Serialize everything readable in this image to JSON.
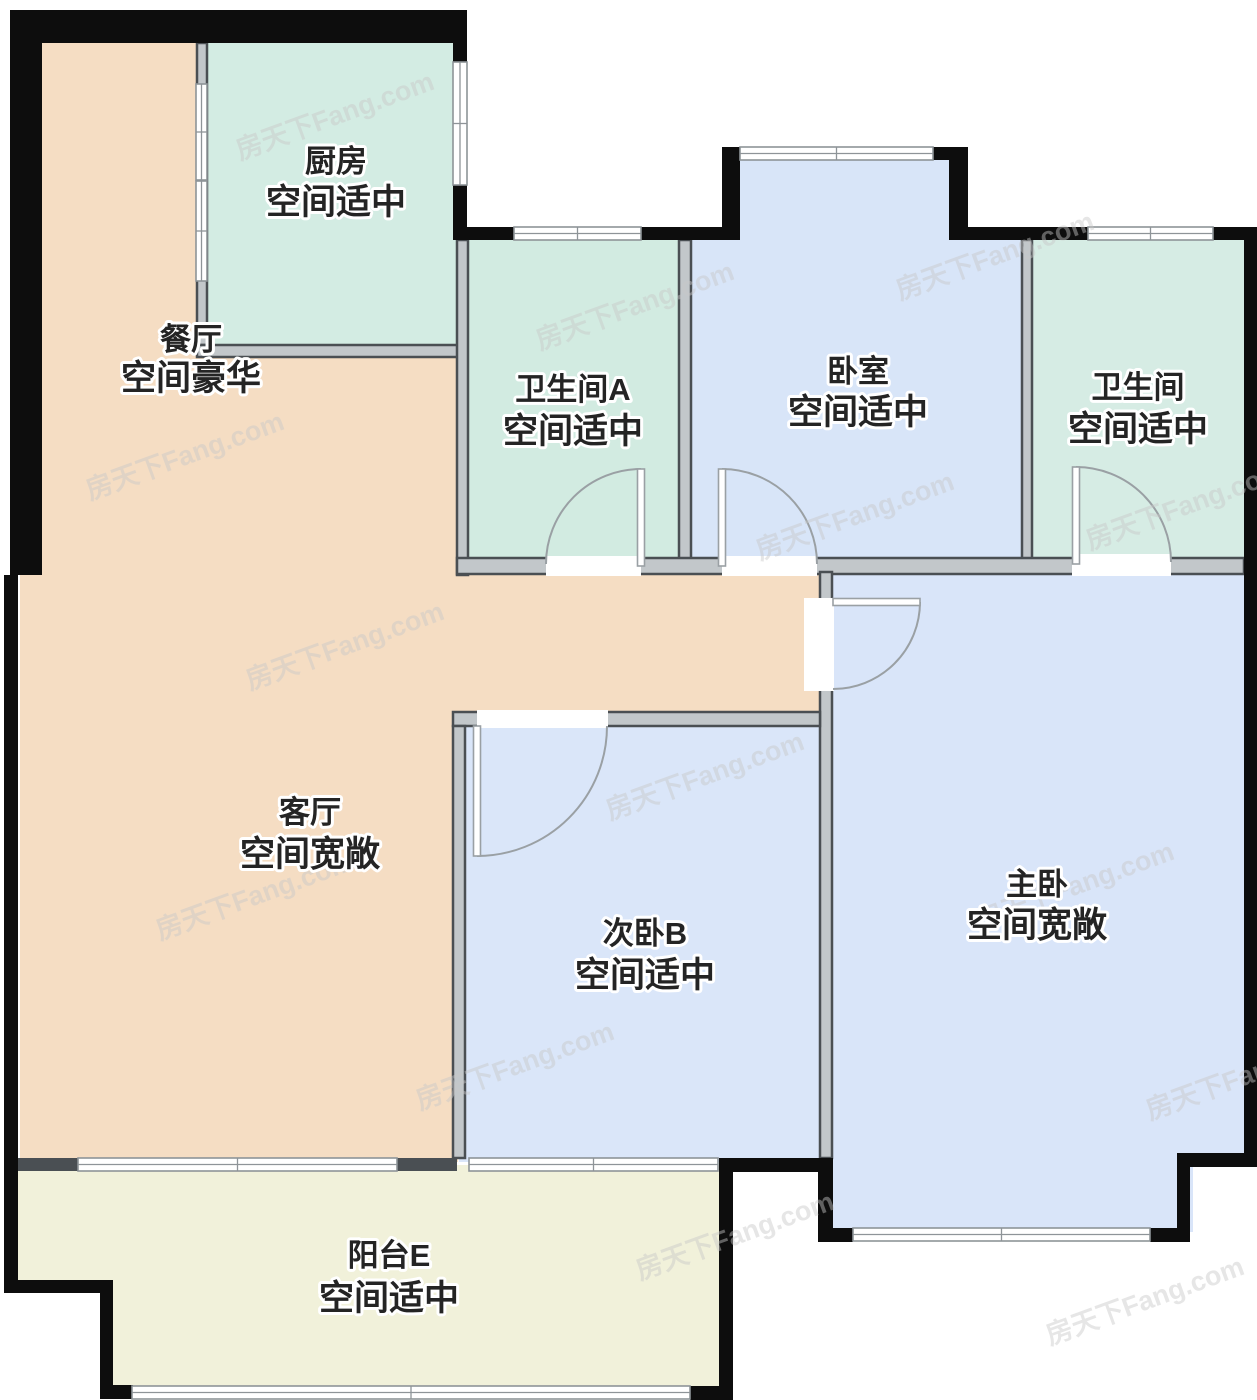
{
  "floorplan": {
    "canvas": {
      "width": 1257,
      "height": 1400,
      "background": "#ffffff"
    },
    "colors": {
      "exterior_wall": "#0d0d0d",
      "interior_wall_fill": "#c2c7ca",
      "interior_wall_edge": "#4a4f53",
      "stub_wall_fill": "#4a4f53",
      "window_stroke": "#8e9498",
      "door_stroke": "#9aa0a4",
      "label_color": "#242424",
      "label_halo": "#ffffff",
      "watermark_color": "#d2d2d2"
    },
    "watermark": {
      "text": "房天下Fang.com",
      "font_size": 27,
      "rotation": -20,
      "opacity": 0.45,
      "positions": [
        [
          240,
          160
        ],
        [
          90,
          500
        ],
        [
          250,
          690
        ],
        [
          540,
          350
        ],
        [
          160,
          940
        ],
        [
          420,
          1110
        ],
        [
          610,
          820
        ],
        [
          760,
          560
        ],
        [
          900,
          300
        ],
        [
          1090,
          550
        ],
        [
          980,
          930
        ],
        [
          1150,
          1120
        ],
        [
          640,
          1280
        ],
        [
          1050,
          1345
        ]
      ]
    },
    "areas": [
      {
        "id": "dining-living",
        "color": "#f5ddc3",
        "rects": [
          [
            20,
            20,
            185,
            340
          ],
          [
            20,
            340,
            440,
            240
          ],
          [
            20,
            566,
            806,
            152
          ],
          [
            20,
            712,
            438,
            450
          ]
        ]
      },
      {
        "id": "kitchen",
        "color": "#d3ece3",
        "rects": [
          [
            203,
            40,
            255,
            310
          ]
        ]
      },
      {
        "id": "bath-a",
        "color": "#d2ebe1",
        "rects": [
          [
            463,
            235,
            221,
            327
          ]
        ]
      },
      {
        "id": "bedroom",
        "color": "#d8e5f8",
        "rects": [
          [
            728,
            152,
            226,
            92
          ],
          [
            686,
            235,
            340,
            327
          ]
        ]
      },
      {
        "id": "bath-right",
        "color": "#d6ece4",
        "rects": [
          [
            1028,
            235,
            220,
            327
          ]
        ]
      },
      {
        "id": "master-bedroom",
        "color": "#d9e5f9",
        "rects": [
          [
            827,
            566,
            420,
            592
          ],
          [
            827,
            1150,
            366,
            82
          ]
        ]
      },
      {
        "id": "bedroom-b",
        "color": "#dae6f9",
        "rects": [
          [
            459,
            718,
            365,
            444
          ]
        ]
      },
      {
        "id": "balcony",
        "color": "#f1f1da",
        "rects": [
          [
            18,
            1165,
            704,
            120
          ],
          [
            108,
            1270,
            614,
            120
          ]
        ]
      }
    ],
    "exterior_walls": [
      [
        10,
        10,
        457,
        33
      ],
      [
        10,
        10,
        32,
        565
      ],
      [
        4,
        575,
        14,
        717
      ],
      [
        453,
        43,
        14,
        19
      ],
      [
        453,
        185,
        14,
        55
      ],
      [
        453,
        227,
        61,
        13
      ],
      [
        641,
        227,
        99,
        13
      ],
      [
        722,
        147,
        18,
        93
      ],
      [
        933,
        147,
        35,
        13
      ],
      [
        949,
        147,
        19,
        93
      ],
      [
        968,
        227,
        120,
        13
      ],
      [
        1213,
        227,
        44,
        13
      ],
      [
        1244,
        227,
        13,
        940
      ],
      [
        1177,
        1153,
        80,
        14
      ],
      [
        1177,
        1153,
        13,
        89
      ],
      [
        1150,
        1228,
        40,
        14
      ],
      [
        818,
        1228,
        35,
        14
      ],
      [
        818,
        1158,
        15,
        84
      ],
      [
        719,
        1158,
        114,
        14
      ],
      [
        719,
        1158,
        14,
        242
      ],
      [
        690,
        1386,
        43,
        14
      ],
      [
        100,
        1385,
        33,
        14
      ],
      [
        100,
        1280,
        13,
        119
      ],
      [
        4,
        1280,
        109,
        13
      ]
    ],
    "interior_walls": [
      [
        197,
        43,
        10,
        302
      ],
      [
        197,
        345,
        270,
        12
      ],
      [
        457,
        240,
        11,
        335
      ],
      [
        679,
        240,
        12,
        332
      ],
      [
        1022,
        240,
        10,
        332
      ],
      [
        457,
        558,
        787,
        16
      ],
      [
        820,
        572,
        12,
        586
      ],
      [
        453,
        712,
        367,
        14
      ],
      [
        453,
        726,
        12,
        432
      ]
    ],
    "stub_walls": [
      [
        18,
        1158,
        60,
        13
      ],
      [
        397,
        1158,
        60,
        13
      ]
    ],
    "door_gaps": [
      [
        546,
        556,
        95,
        20
      ],
      [
        722,
        556,
        95,
        20
      ],
      [
        1072,
        554,
        99,
        22
      ],
      [
        804,
        598,
        30,
        93
      ],
      [
        477,
        710,
        131,
        18
      ]
    ],
    "windows": [
      {
        "x": 453,
        "y": 62,
        "w": 14,
        "h": 123,
        "o": "v"
      },
      {
        "x": 196,
        "y": 84,
        "w": 11,
        "h": 96,
        "o": "v"
      },
      {
        "x": 196,
        "y": 181,
        "w": 11,
        "h": 100,
        "o": "v"
      },
      {
        "x": 514,
        "y": 227,
        "w": 127,
        "h": 13,
        "o": "h"
      },
      {
        "x": 740,
        "y": 147,
        "w": 193,
        "h": 13,
        "o": "h"
      },
      {
        "x": 1088,
        "y": 227,
        "w": 125,
        "h": 13,
        "o": "h"
      },
      {
        "x": 853,
        "y": 1228,
        "w": 297,
        "h": 13,
        "o": "h"
      },
      {
        "x": 469,
        "y": 1158,
        "w": 249,
        "h": 13,
        "o": "h"
      },
      {
        "x": 78,
        "y": 1158,
        "w": 319,
        "h": 13,
        "o": "h"
      },
      {
        "x": 132,
        "y": 1386,
        "w": 558,
        "h": 13,
        "o": "h"
      }
    ],
    "doors": [
      {
        "id": "door-bath-a",
        "arc": "M 546 564 A 95 95 0 0 1 641 469",
        "leaf": [
          637.5,
          469,
          7,
          97
        ]
      },
      {
        "id": "door-bedroom",
        "arc": "M 722 469 A 95 95 0 0 1 817 564",
        "leaf": [
          718.5,
          469,
          7,
          97
        ]
      },
      {
        "id": "door-bath-right",
        "arc": "M 1076 467 A 95 95 0 0 1 1171 562",
        "leaf": [
          1072.5,
          467,
          7,
          97
        ]
      },
      {
        "id": "door-master",
        "arc": "M 920 602 A 87 87 0 0 1 833 689",
        "leaf": [
          833,
          598.5,
          87,
          7
        ]
      },
      {
        "id": "door-bedroom-b",
        "arc": "M 477 856 A 130 130 0 0 0 607 726",
        "leaf": [
          473.5,
          726,
          7,
          130
        ]
      }
    ],
    "labels": [
      {
        "id": "kitchen",
        "line1": "厨房",
        "line2": "空间适中",
        "x": 336,
        "y1": 172,
        "y2": 214
      },
      {
        "id": "dining",
        "line1": "餐厅",
        "line2": "空间豪华",
        "x": 191,
        "y1": 350,
        "y2": 390
      },
      {
        "id": "bath-a",
        "line1": "卫生间A",
        "line2": "空间适中",
        "x": 573,
        "y1": 400,
        "y2": 443
      },
      {
        "id": "bedroom",
        "line1": "卧室",
        "line2": "空间适中",
        "x": 858,
        "y1": 382,
        "y2": 424
      },
      {
        "id": "bath-right",
        "line1": "卫生间",
        "line2": "空间适中",
        "x": 1138,
        "y1": 398,
        "y2": 441
      },
      {
        "id": "living",
        "line1": "客厅",
        "line2": "空间宽敞",
        "x": 310,
        "y1": 823,
        "y2": 866
      },
      {
        "id": "bedroom-b",
        "line1": "次卧B",
        "line2": "空间适中",
        "x": 645,
        "y1": 944,
        "y2": 987
      },
      {
        "id": "master-bedroom",
        "line1": "主卧",
        "line2": "空间宽敞",
        "x": 1037,
        "y1": 895,
        "y2": 937
      },
      {
        "id": "balcony",
        "line1": "阳台E",
        "line2": "空间适中",
        "x": 389,
        "y1": 1266,
        "y2": 1310
      }
    ],
    "label_font": {
      "size1": 31,
      "size2": 35
    }
  }
}
